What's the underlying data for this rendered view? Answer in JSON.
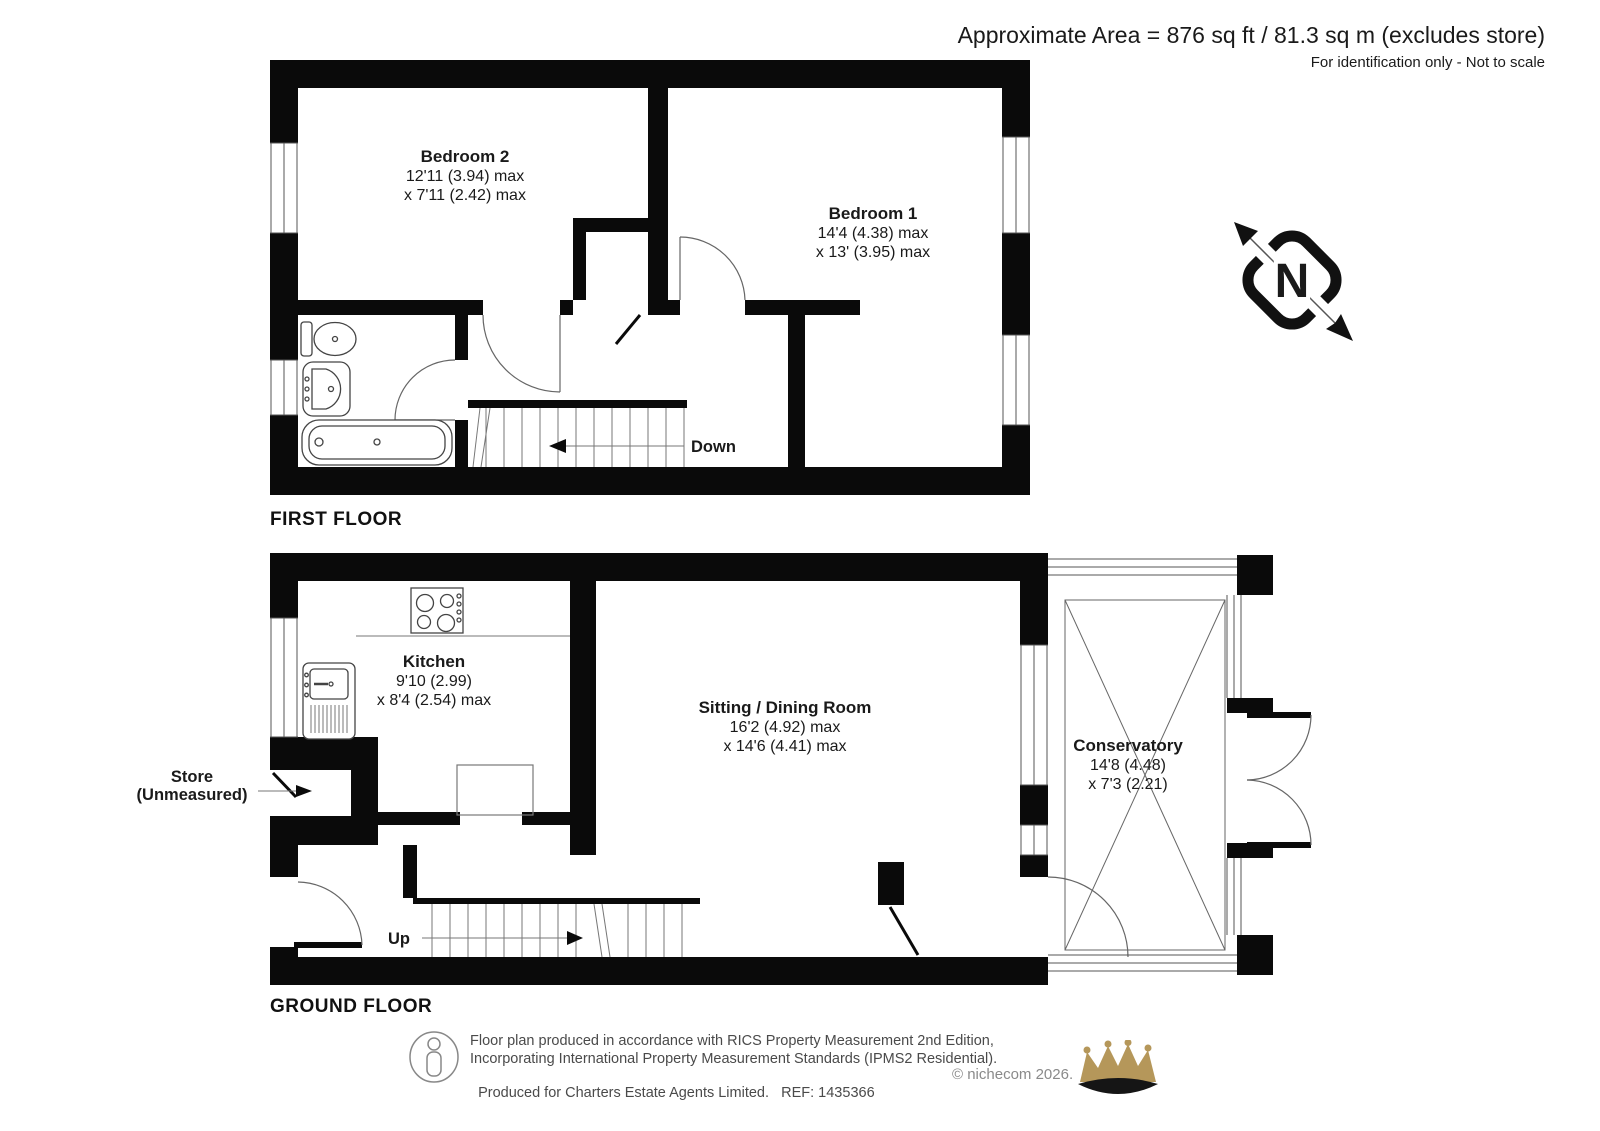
{
  "header": {
    "area": "Approximate Area = 876 sq ft / 81.3 sq m (excludes store)",
    "note": "For identification only - Not to scale"
  },
  "first_floor": {
    "title": "FIRST FLOOR",
    "bedroom2": {
      "name": "Bedroom 2",
      "dim1": "12'11 (3.94) max",
      "dim2": "x 7'11 (2.42) max"
    },
    "bedroom1": {
      "name": "Bedroom 1",
      "dim1": "14'4 (4.38) max",
      "dim2": "x 13' (3.95) max"
    },
    "down": "Down"
  },
  "ground_floor": {
    "title": "GROUND FLOOR",
    "kitchen": {
      "name": "Kitchen",
      "dim1": "9'10 (2.99)",
      "dim2": "x 8'4 (2.54) max"
    },
    "sitting_dining": {
      "name": "Sitting / Dining Room",
      "dim1": "16'2 (4.92) max",
      "dim2": "x 14'6 (4.41) max"
    },
    "conservatory": {
      "name": "Conservatory",
      "dim1": "14'8 (4.48)",
      "dim2": "x 7'3 (2.21)"
    },
    "store": {
      "line1": "Store",
      "line2": "(Unmeasured)"
    },
    "up": "Up"
  },
  "compass": {
    "label": "N"
  },
  "footer": {
    "line1": "Floor plan produced in accordance with RICS Property Measurement 2nd Edition,",
    "line2": "Incorporating International Property Measurement Standards (IPMS2 Residential).",
    "produced": "Produced for Charters Estate Agents Limited.",
    "ref": "REF: 1435366",
    "copyright": "© nichecom 2026.",
    "colors": {
      "crown_gold": "#b5975a",
      "crown_dark": "#151515"
    }
  }
}
